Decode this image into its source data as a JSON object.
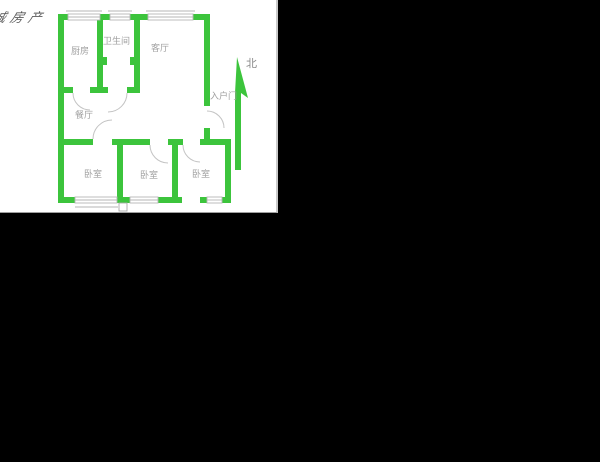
{
  "page": {
    "background": "#000000"
  },
  "watermark": {
    "text": "诚房产"
  },
  "floorplan": {
    "rooms": {
      "kitchen": {
        "label": "厨房"
      },
      "bathroom": {
        "label": "卫生间"
      },
      "living_room": {
        "label": "客厅"
      },
      "dining_room": {
        "label": "餐厅"
      },
      "bedroom_left": {
        "label": "卧室"
      },
      "bedroom_middle": {
        "label": "卧室"
      },
      "bedroom_right": {
        "label": "卧室"
      }
    },
    "entrance": {
      "label": "入户门"
    },
    "compass": {
      "north_label": "北"
    },
    "colors": {
      "wall_green": "#3cc43c",
      "label_gray": "#a0a0a0",
      "line_gray": "#b5b5b5",
      "plan_bg": "#ffffff",
      "page_bg": "#000000"
    }
  }
}
